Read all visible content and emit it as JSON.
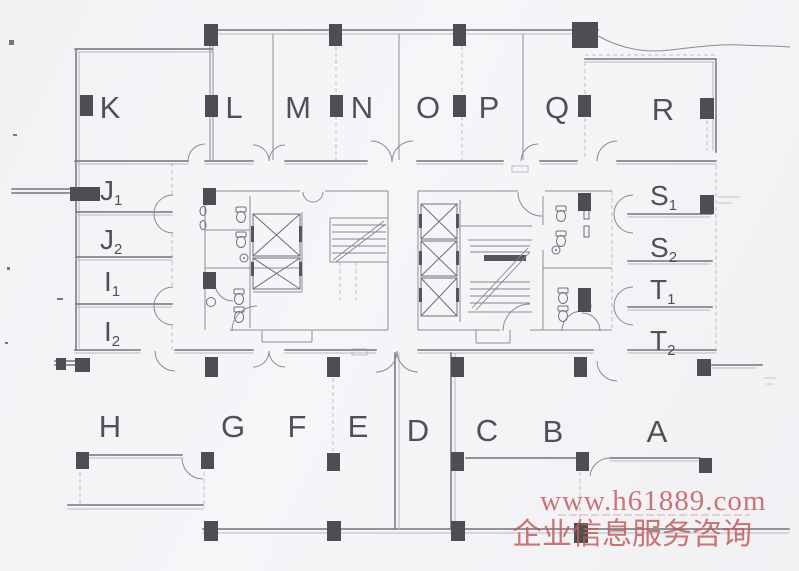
{
  "watermark": {
    "url_text": "www.h61889.com",
    "caption": "企业信息服务咨询",
    "color": "#c05b59"
  },
  "rooms": {
    "top": [
      {
        "label": "K"
      },
      {
        "label": "L"
      },
      {
        "label": "M"
      },
      {
        "label": "N"
      },
      {
        "label": "O"
      },
      {
        "label": "P"
      },
      {
        "label": "Q"
      },
      {
        "label": "R"
      }
    ],
    "left": [
      {
        "main": "J",
        "sub": "1"
      },
      {
        "main": "J",
        "sub": "2"
      },
      {
        "main": "I",
        "sub": "1"
      },
      {
        "main": "I",
        "sub": "2"
      }
    ],
    "right": [
      {
        "main": "S",
        "sub": "1"
      },
      {
        "main": "S",
        "sub": "2"
      },
      {
        "main": "T",
        "sub": "1"
      },
      {
        "main": "T",
        "sub": "2"
      }
    ],
    "bottom": [
      {
        "label": "H"
      },
      {
        "label": "G"
      },
      {
        "label": "F"
      },
      {
        "label": "E"
      },
      {
        "label": "D"
      },
      {
        "label": "C"
      },
      {
        "label": "B"
      },
      {
        "label": "A"
      }
    ]
  },
  "plan": {
    "paper_color": "#f4f3f6",
    "ink_color": "#73737a",
    "column_color": "#4d4d54",
    "label_color": "#3a3a40"
  }
}
